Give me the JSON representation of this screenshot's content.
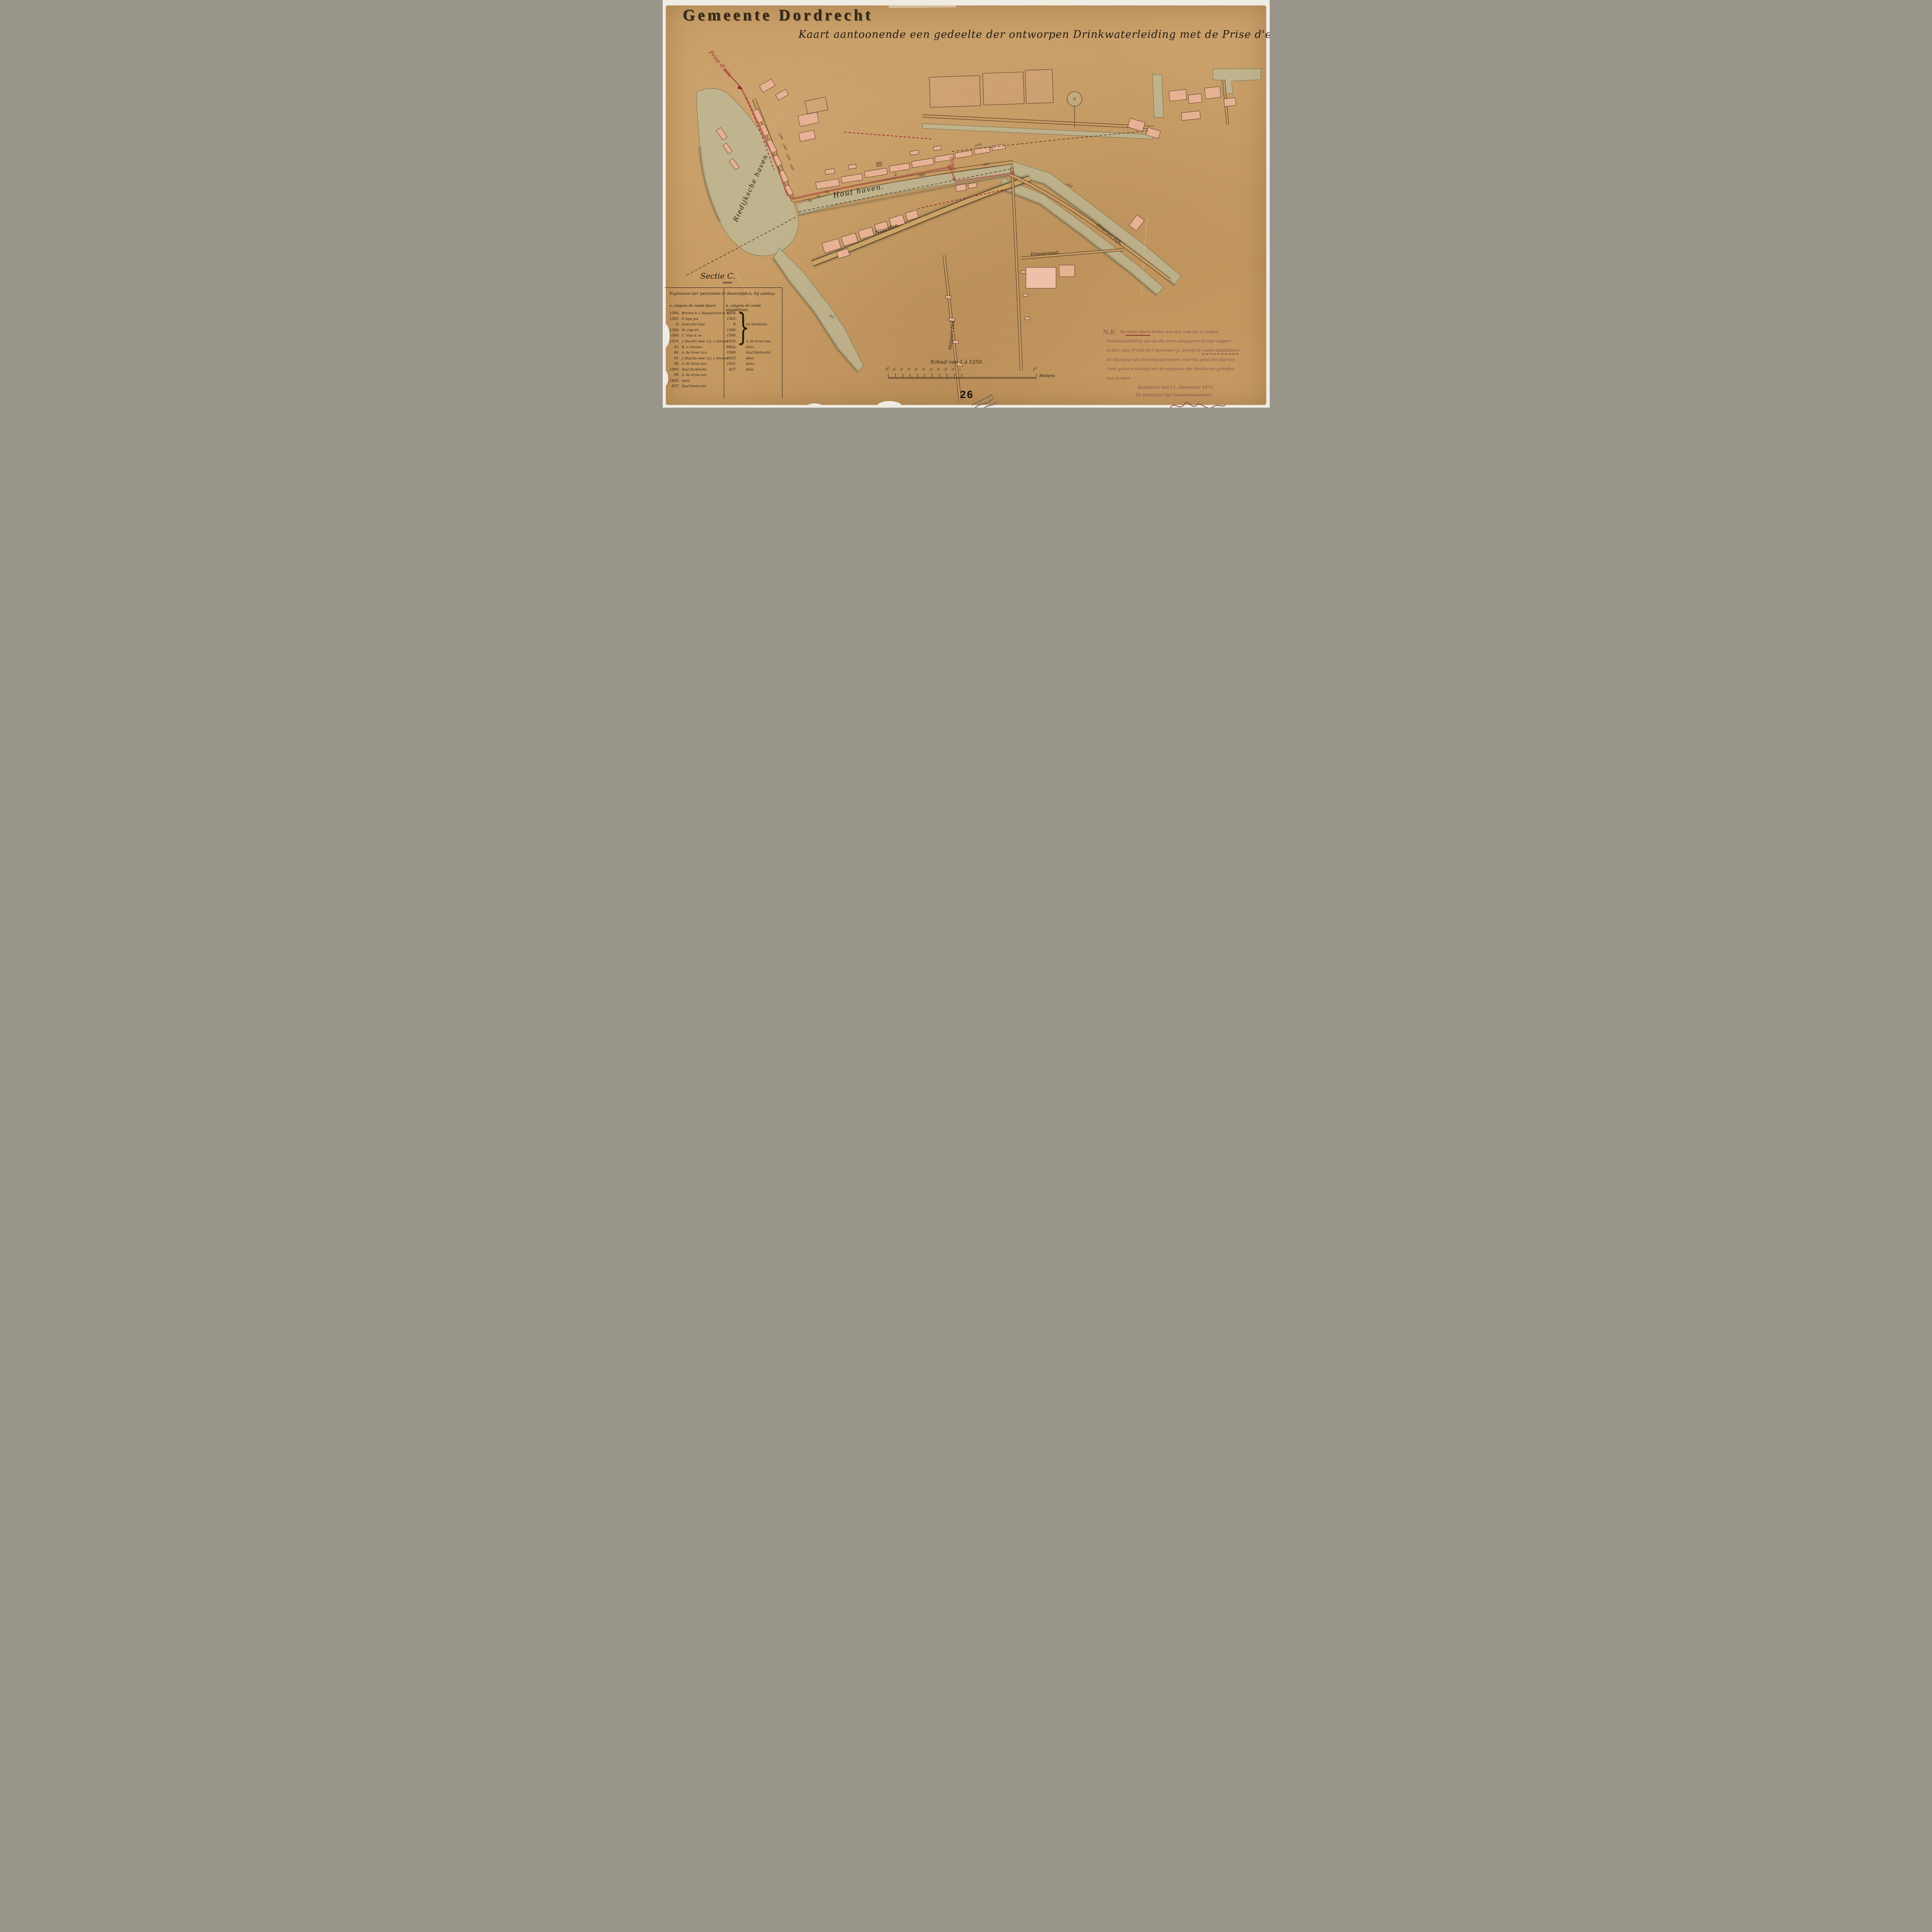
{
  "header": {
    "municipality": "Gemeente Dordrecht",
    "map_title": "Kaart aantoonende een gedeelte der ontworpen Drinkwaterleiding met de Prise d'eau."
  },
  "map_labels": {
    "prise_deau": "Prise d'eau",
    "riedijksche_haven": "Riedijksche haven",
    "houthaven": "Hout haven.",
    "zinker": "Zinker.",
    "matenaspad": "Matena's pad.",
    "emousenpad": "Emousenpad.",
    "groenendijk": "Groenen dijk.",
    "noordendijk": "Noorden",
    "p1518": "1518.",
    "p99": "99.",
    "p1869": "1869",
    "p40": "40",
    "p45": "45",
    "p44": "44",
    "p41": "41",
    "p43": "43",
    "p1836": "1836",
    "p1633": "1633",
    "p1504": "1504",
    "p1505": "1505",
    "p1506": "1506",
    "p1509": "1509",
    "p837": "837"
  },
  "legend": {
    "section_title": "Sectie C.",
    "table_header": "Eigenaren der perceelen te doorsnijden, bij aanleg:",
    "col_a_header": "a. volgens de roode lijnen.",
    "col_b_header": "b. volgens de roode stippellijnen.",
    "brace": "}",
    "col_a_rows": [
      {
        "num": "1504.",
        "owner": "Boonen & v. Hoogstraten & zn"
      },
      {
        "num": "1505.",
        "owner": "P. Gips Jzn."
      },
      {
        "num": "8.",
        "owner": "erven Jan Gips."
      },
      {
        "num": "1506.",
        "owner": "M. Gips Pz."
      },
      {
        "num": "1509.",
        "owner": "C. Gips & zn"
      },
      {
        "num": "1514.",
        "owner": "J. Mauritz wed. G.J. v. Dorsser"
      },
      {
        "num": "43.",
        "owner": "B. v. Limmen."
      },
      {
        "num": "44.",
        "owner": "A. de Groot Azn."
      },
      {
        "num": "45.",
        "owner": "J. Mauritz wed. G.J. v. Dorsser."
      },
      {
        "num": "58.",
        "owner": "A. de Groot Azn."
      },
      {
        "num": "1969.",
        "owner": "Stad Dordrecht."
      },
      {
        "num": "99.",
        "owner": "A. de Groot Azn."
      },
      {
        "num": "1465.",
        "owner": "idem"
      },
      {
        "num": "837.",
        "owner": "Stad Dordrecht."
      }
    ],
    "col_b_rows": [
      {
        "num": "1504.",
        "owner": ""
      },
      {
        "num": "1505.",
        "owner": ""
      },
      {
        "num": "8.",
        "owner": "zie hierneven."
      },
      {
        "num": "1506.",
        "owner": ""
      },
      {
        "num": "1509.",
        "owner": ""
      },
      {
        "num": "1518.",
        "owner": "A. de Groot Azn."
      },
      {
        "num": "58bis.",
        "owner": "idem."
      },
      {
        "num": "1969.",
        "owner": "Stad Dordrecht."
      },
      {
        "num": "1633.",
        "owner": "idem."
      },
      {
        "num": "1631.",
        "owner": "idem."
      },
      {
        "num": "837.",
        "owner": "idem"
      }
    ]
  },
  "note": {
    "label": "N.B.",
    "line1": "De roode lijnen duiden aan den loop der te maken",
    "line2": "Drinkwaterleiding zoo als die werd aangegeven in mijn rapport",
    "line3": "te dier zake N°320 dd 3 November jl., terwijl de roode stippellijnen",
    "line4": "de wijziging van dien loop aantoonen, voor het geval dat daarom-",
    "line5": "trent geene schikking met de eigenaars der Houthaven getroffen",
    "line6": "kan worden.",
    "place_date": "Dordrecht den 11. December 1873.",
    "signoff": "De Directeur der Gemeentewerken"
  },
  "scale": {
    "label": "Schaal van 1 à 1250.",
    "unit": "Meters.",
    "left_ticks": [
      "100",
      "90",
      "80",
      "70",
      "60",
      "50",
      "40",
      "30",
      "20",
      "10",
      "0"
    ],
    "right_tick": "100"
  },
  "page_number": "26",
  "colors": {
    "paper": "#c69a63",
    "ink": "#241c12",
    "pipeline_red": "#9e2a33",
    "note_ink": "#8d4a52",
    "building_fill": "#e7b193",
    "water_fill": "#b9c2a6"
  }
}
